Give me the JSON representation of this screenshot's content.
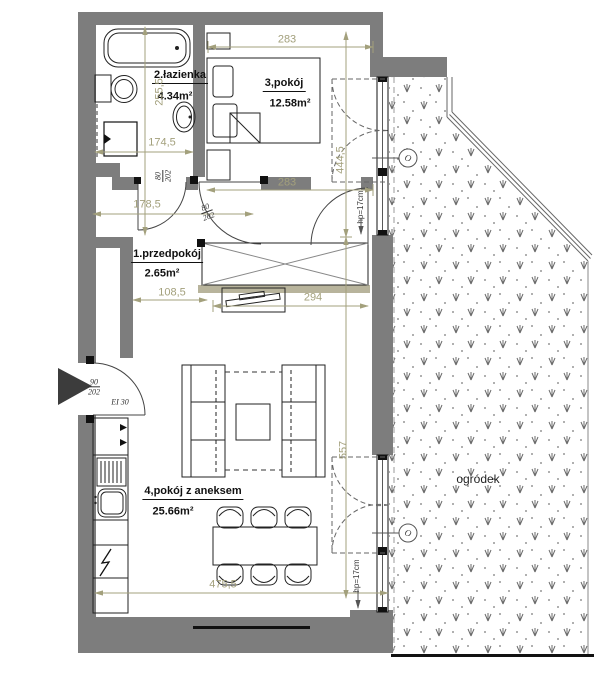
{
  "plan": {
    "rooms": {
      "hallway": {
        "label": "1.przedpokój",
        "area": "2.65m²"
      },
      "bathroom": {
        "label": "2.łazienka",
        "area": "4.34m²"
      },
      "bedroom": {
        "label": "3,pokój",
        "area": "12.58m²"
      },
      "living": {
        "label": "4,pokój z aneksem",
        "area": "25.66m²"
      },
      "garden": {
        "label": "ogródek"
      }
    },
    "dimensions": {
      "bedroom_width_top": "283",
      "bedroom_width_bottom": "283",
      "bathroom_width": "174,5",
      "bathroom_depth": "255,5",
      "corridor_width": "178,5",
      "hallway_width": "108,5",
      "living_width_top": "294",
      "living_width_bottom": "475,5",
      "right_side_upper": "444,5",
      "right_side_lower": "557"
    },
    "doors": {
      "bathroom_door": {
        "width": "80",
        "height": "202"
      },
      "bedroom_door": {
        "width": "80",
        "height": "202"
      },
      "entrance_door": {
        "width": "90",
        "height": "202",
        "fire_rating": "EI 30"
      }
    },
    "windows": {
      "parapet_upper": "hp=17cm",
      "parapet_lower": "hp=17cm",
      "tag_upper": "O",
      "tag_lower": "O"
    },
    "colors": {
      "wall": "#7d7d7d",
      "dimension": "#a3a07c",
      "niche": "#b8b49c",
      "outline": "#1a1a1a"
    }
  }
}
